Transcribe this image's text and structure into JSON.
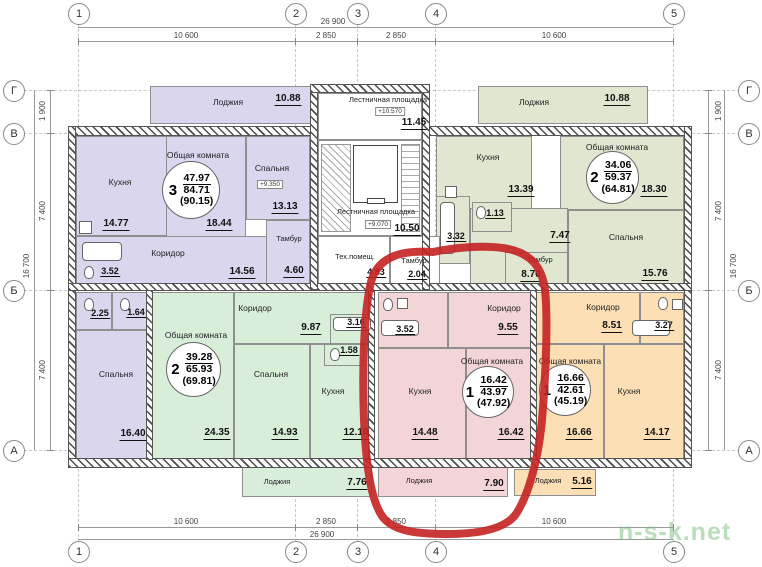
{
  "watermark": "n-s-k.net",
  "colors": {
    "apt3_lavender": "#d9d6ee",
    "apt2_right_olive": "#e0e6d0",
    "apt2_left_mint": "#d8eed9",
    "apt1_center_pink": "#f3d5d8",
    "apt1_right_orange": "#fcdfb4",
    "annotation_red": "#c42222"
  },
  "axes": {
    "cols": [
      "1",
      "2",
      "3",
      "4",
      "5"
    ],
    "rows": [
      "Г",
      "В",
      "Б",
      "А"
    ]
  },
  "dims": {
    "h_total": "26 900",
    "h_segs": [
      "10 600",
      "2 850",
      "2 850",
      "10 600"
    ],
    "v_total": "16 700",
    "v_segs": [
      "1 900",
      "7 400",
      "7 400"
    ]
  },
  "stair_block": {
    "upper_landing": {
      "label": "Лестничная площадка",
      "elevation": "+10.570",
      "area": "11.45"
    },
    "lower_landing": {
      "label": "Лестничная площадка",
      "elevation": "+9.070",
      "area": "10.50"
    },
    "tech_room": {
      "label": "Тех.помещ.",
      "area": "4.83"
    },
    "tambour": {
      "label": "Тамбур",
      "area": "2.04"
    }
  },
  "apartments": {
    "apt3": {
      "stamp": {
        "rooms": "3",
        "living_area": "47.97",
        "total_area": "84.71",
        "with_lodge": "(90.15)"
      },
      "lodge": {
        "label": "Лоджия",
        "area": "10.88"
      },
      "kitchen": {
        "label": "Кухня",
        "area": "14.77"
      },
      "living": {
        "label": "Общая комната",
        "area": "18.44"
      },
      "bedroom1": {
        "label": "Спальня",
        "elevation": "+9.350",
        "area": "13.13"
      },
      "corridor": {
        "label": "Коридор",
        "area": "14.56"
      },
      "tambour": {
        "label": "Тамбур",
        "area": "4.60"
      },
      "bathroom": {
        "area": "3.52"
      },
      "wc": {
        "area": "2.25"
      },
      "bath2": {
        "area": "1.64"
      },
      "bedroom2": {
        "label": "Спальня",
        "area": "16.40"
      }
    },
    "apt2_right": {
      "stamp": {
        "rooms": "2",
        "living_area": "34.06",
        "total_area": "59.37",
        "with_lodge": "(64.81)"
      },
      "lodge": {
        "label": "Лоджия",
        "area": "10.88"
      },
      "kitchen": {
        "label": "Кухня",
        "area": "13.39"
      },
      "living": {
        "label": "Общая комната",
        "area": "18.30"
      },
      "bedroom": {
        "label": "Спальня",
        "area": "15.76"
      },
      "corridor": {
        "area": "7.47"
      },
      "wc": {
        "area": "1.13"
      },
      "bathroom": {
        "area": "3.32"
      },
      "tambour": {
        "label": "Тамбур",
        "area": "8.70"
      }
    },
    "apt2_left": {
      "stamp": {
        "rooms": "2",
        "living_area": "39.28",
        "total_area": "65.93",
        "with_lodge": "(69.81)"
      },
      "living": {
        "label": "Общая комната",
        "area": "24.35"
      },
      "bedroom": {
        "label": "Спальня",
        "area": "14.93"
      },
      "corridor": {
        "label": "Коридор",
        "area": "9.87"
      },
      "kitchen": {
        "label": "Кухня",
        "area": "12.10"
      },
      "bathroom": {
        "area": "3.16"
      },
      "wc": {
        "area": "1.58"
      },
      "lodge": {
        "label": "Лоджия",
        "area": "7.76"
      }
    },
    "apt1_center": {
      "stamp": {
        "rooms": "1",
        "living_area": "16.42",
        "total_area": "43.97",
        "with_lodge": "(47.92)"
      },
      "bathroom": {
        "area": "3.52"
      },
      "corridor": {
        "label": "Коридор",
        "area": "9.55"
      },
      "kitchen": {
        "label": "Кухня",
        "area": "14.48"
      },
      "living": {
        "label": "Общая комната",
        "area": "16.42"
      },
      "lodge": {
        "label": "Лоджия",
        "area": "7.90"
      }
    },
    "apt1_right": {
      "stamp": {
        "rooms": "1",
        "living_area": "16.66",
        "total_area": "42.61",
        "with_lodge": "(45.19)"
      },
      "corridor": {
        "label": "Коридор",
        "area": "8.51"
      },
      "bathroom": {
        "area": "3.27"
      },
      "living": {
        "label": "Общая комната",
        "area": "16.66"
      },
      "kitchen": {
        "label": "Кухня",
        "area": "14.17"
      },
      "lodge": {
        "label": "Лоджия",
        "area": "5.16"
      }
    }
  }
}
